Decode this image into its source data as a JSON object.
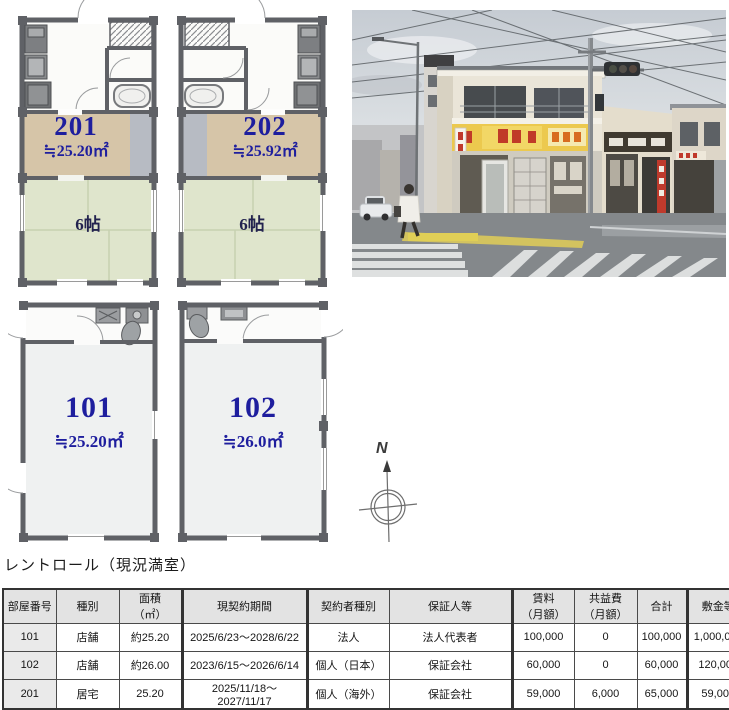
{
  "floor_plans": {
    "unit_201": {
      "number": "201",
      "area": "≒25.20㎡",
      "room_size": "6帖"
    },
    "unit_202": {
      "number": "202",
      "area": "≒25.92㎡",
      "room_size": "6帖"
    },
    "unit_101": {
      "number": "101",
      "area": "≒25.20㎡"
    },
    "unit_102": {
      "number": "102",
      "area": "≒26.0㎡"
    }
  },
  "compass": {
    "north_label": "N"
  },
  "rent_roll": {
    "title": "レントロール（現況満室）",
    "columns": [
      "部屋番号",
      "種別",
      "面積\n（㎡）",
      "現契約期間",
      "契約者種別",
      "保証人等",
      "賃料\n（月額）",
      "共益費\n（月額）",
      "合計",
      "敷金等"
    ],
    "rows": [
      [
        "101",
        "店舗",
        "約25.20",
        "2025/6/23～2028/6/22",
        "法人",
        "法人代表者",
        "100,000",
        "0",
        "100,000",
        "1,000,000"
      ],
      [
        "102",
        "店舗",
        "約26.00",
        "2023/6/15～2026/6/14",
        "個人（日本）",
        "保証会社",
        "60,000",
        "0",
        "60,000",
        "120,000"
      ],
      [
        "201",
        "居宅",
        "25.20",
        "2025/11/18～2027/11/17",
        "個人（海外）",
        "保証会社",
        "59,000",
        "6,000",
        "65,000",
        "59,000"
      ]
    ]
  },
  "colors": {
    "unit_text": "#1e1e9e",
    "tan_room": "#d6c5a8",
    "tatami_green": "#dfe5cc",
    "wall_gray": "#5f6166",
    "sign_yellow": "#ecc94e"
  }
}
